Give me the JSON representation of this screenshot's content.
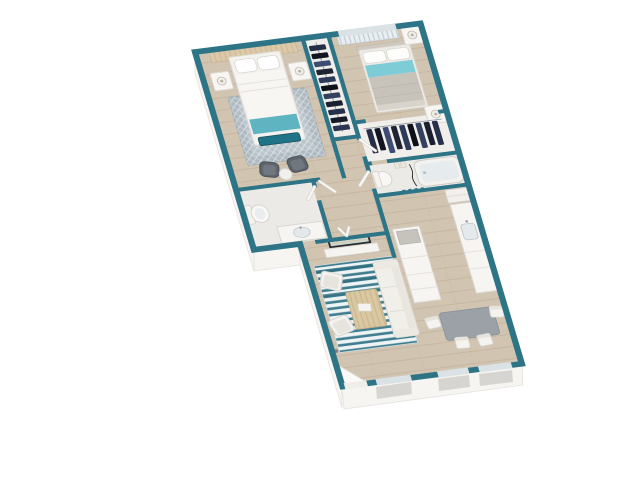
{
  "scene": {
    "kind": "3d-apartment-floor-plan-render",
    "background": "#ffffff",
    "view": "rotated top-down dollhouse render, no text labels"
  },
  "palette": {
    "wall_teal": "#2d7486",
    "floor_wood": "#d1c4b1",
    "floor_tile": "#eceae6",
    "exterior_face": "#f6f5f1",
    "window_glass": "#dae2e6",
    "rug_stripe_teal": "#417f90",
    "rug_gray": "#aeb9c1",
    "accent_teal": "#5fb4c2",
    "accent_teal_dark": "#1f7488",
    "accent_teal_light": "#7ecdd6",
    "dining_table_gray": "#9ba1a6",
    "clothes_navy": "#262e47",
    "furniture_white": "#f5f4f1",
    "wood_table": "#d9c8a2"
  },
  "rooms": [
    {
      "id": "bedroom-1",
      "contents": [
        "queen-bed-white-teal-throw",
        "teal-bench",
        "two-nightstands-with-lamps",
        "patterned-gray-rug",
        "headboard-wall-panel",
        "two-dark-accent-chairs",
        "round-side-table"
      ]
    },
    {
      "id": "closet-1",
      "contents": [
        "hanging-clothes-rack"
      ]
    },
    {
      "id": "bedroom-2",
      "contents": [
        "queen-bed-gray-with-teal-stripe",
        "two-nightstands-with-lamps",
        "window-blinds",
        "wide-closet-hanging-clothes"
      ]
    },
    {
      "id": "bathroom-1",
      "contents": [
        "toilet",
        "vanity-sink"
      ]
    },
    {
      "id": "bathroom-2",
      "contents": [
        "bathtub",
        "toilet",
        "light-switches",
        "cord"
      ]
    },
    {
      "id": "hallway",
      "contents": [
        "interior-door-leaves",
        "closet-bifold-doors"
      ]
    },
    {
      "id": "kitchen",
      "contents": [
        "refrigerator",
        "wall-counter-with-sink",
        "island-counter-with-appliance",
        "teal-vent-dots"
      ]
    },
    {
      "id": "living-room",
      "contents": [
        "striped-teal-rug",
        "sofa",
        "two-light-accent-chairs",
        "slatted-coffee-table",
        "wall-tv",
        "media-console",
        "entry-door-open-leaf"
      ]
    },
    {
      "id": "dining-area",
      "contents": [
        "gray-dining-table",
        "four-white-chairs"
      ]
    }
  ],
  "windows": [
    "bedroom-2-top-wall",
    "living-room-bottom-wall",
    "dining-bottom-wall-left",
    "dining-bottom-wall-right"
  ]
}
